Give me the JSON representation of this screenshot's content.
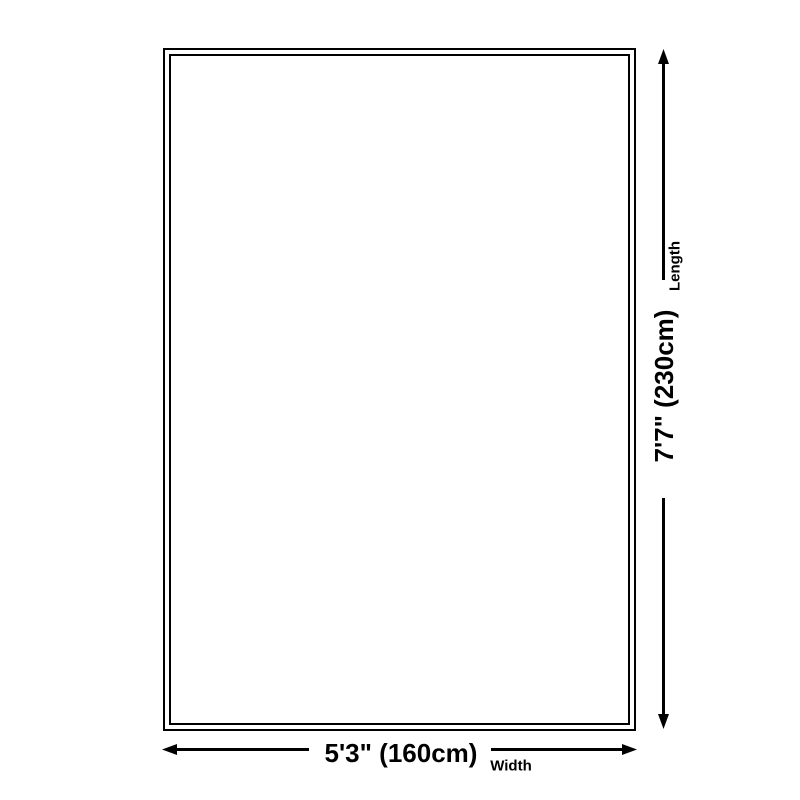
{
  "colors": {
    "background": "#ffffff",
    "line": "#000000",
    "text": "#000000"
  },
  "dimensions": {
    "length": {
      "label": "Length",
      "value": "7'7\" (230cm)"
    },
    "width": {
      "label": "Width",
      "value": "5'3\" (160cm)"
    }
  }
}
